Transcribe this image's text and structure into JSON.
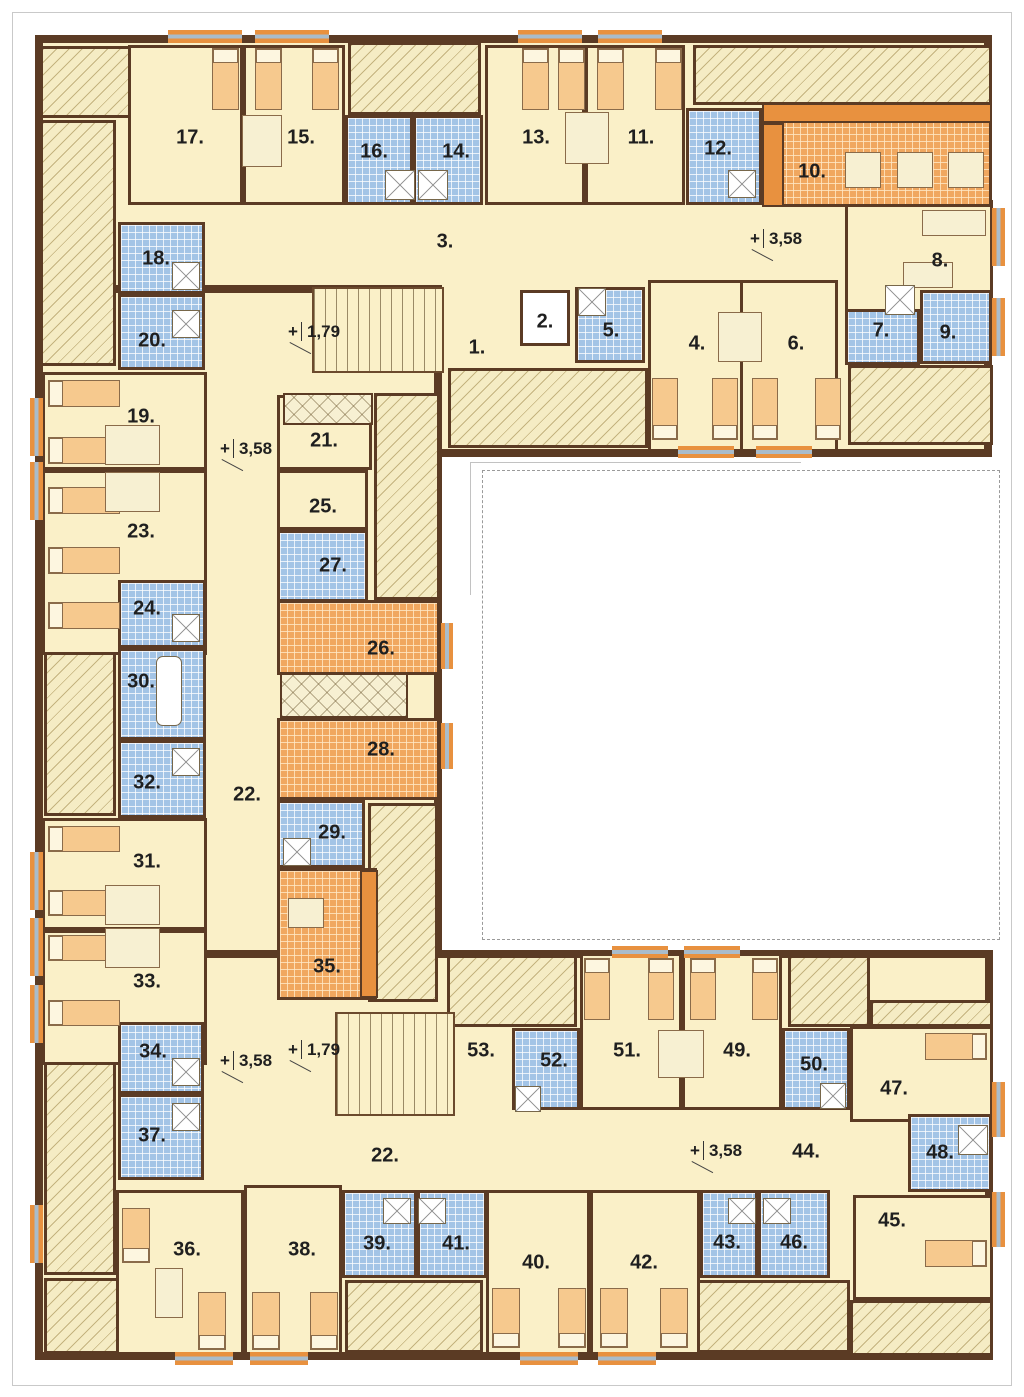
{
  "plan_title": "Floor plan – level +3,58 / +1,79",
  "colors": {
    "wall": "#5b3b24",
    "floor_cream": "#faf0c8",
    "tile_blue": "#a3c4e6",
    "tile_orange": "#f0a75f",
    "accent_orange": "#e8913f",
    "hatch_bg": "#f5ecc4",
    "window_glass": "#a9bccb",
    "bed_orange": "#f6c98e"
  },
  "wings": [
    {
      "name": "wing-top",
      "rect": [
        35,
        35,
        957,
        422
      ]
    },
    {
      "name": "wing-left",
      "rect": [
        35,
        285,
        407,
        912
      ]
    },
    {
      "name": "wing-bottom",
      "rect": [
        35,
        950,
        958,
        410
      ]
    }
  ],
  "hatches": [
    [
      40,
      46,
      93,
      72
    ],
    [
      40,
      120,
      76,
      246
    ],
    [
      348,
      42,
      133,
      73
    ],
    [
      693,
      45,
      299,
      60
    ],
    [
      448,
      368,
      200,
      80
    ],
    [
      848,
      365,
      145,
      80
    ],
    [
      374,
      393,
      66,
      207
    ],
    [
      44,
      580,
      72,
      236
    ],
    [
      368,
      803,
      70,
      199
    ],
    [
      44,
      1022,
      72,
      253
    ],
    [
      44,
      1278,
      93,
      76
    ],
    [
      345,
      1280,
      138,
      73
    ],
    [
      695,
      1280,
      155,
      73
    ],
    [
      447,
      955,
      130,
      72
    ],
    [
      788,
      955,
      82,
      72
    ],
    [
      870,
      1000,
      123,
      27
    ],
    [
      850,
      1300,
      143,
      56
    ]
  ],
  "rooms": [
    {
      "label": "1.",
      "type": "corridor",
      "rect": [
        277,
        285,
        243,
        110
      ],
      "label_pos": [
        477,
        348
      ]
    },
    {
      "label": "2.",
      "type": "elevator",
      "rect": [
        520,
        290,
        50,
        56
      ],
      "label_pos": [
        545,
        322
      ]
    },
    {
      "label": "3.",
      "type": "corridor",
      "rect": [
        205,
        205,
        640,
        80
      ],
      "label_pos": [
        445,
        242
      ]
    },
    {
      "label": "4.",
      "type": "cream",
      "rect": [
        648,
        280,
        95,
        172
      ],
      "label_pos": [
        697,
        344
      ]
    },
    {
      "label": "5.",
      "type": "blue",
      "rect": [
        575,
        287,
        70,
        76
      ],
      "label_pos": [
        611,
        331
      ]
    },
    {
      "label": "6.",
      "type": "cream",
      "rect": [
        740,
        280,
        98,
        172
      ],
      "label_pos": [
        796,
        344
      ]
    },
    {
      "label": "7.",
      "type": "blue",
      "rect": [
        845,
        280,
        75,
        85
      ],
      "label_pos": [
        881,
        331
      ]
    },
    {
      "label": "8.",
      "type": "cream",
      "rect": [
        845,
        200,
        148,
        112
      ],
      "label_pos": [
        940,
        261
      ]
    },
    {
      "label": "9.",
      "type": "blue",
      "rect": [
        920,
        290,
        72,
        74
      ],
      "label_pos": [
        948,
        333
      ]
    },
    {
      "label": "10.",
      "type": "orangetile",
      "rect": [
        762,
        103,
        230,
        104
      ],
      "label_pos": [
        812,
        172
      ]
    },
    {
      "label": "11.",
      "type": "cream",
      "rect": [
        585,
        45,
        100,
        160
      ],
      "label_pos": [
        641,
        138
      ]
    },
    {
      "label": "12.",
      "type": "blue",
      "rect": [
        686,
        108,
        76,
        97
      ],
      "label_pos": [
        718,
        149
      ]
    },
    {
      "label": "13.",
      "type": "cream",
      "rect": [
        485,
        45,
        100,
        160
      ],
      "label_pos": [
        536,
        138
      ]
    },
    {
      "label": "14.",
      "type": "blue",
      "rect": [
        413,
        115,
        70,
        90
      ],
      "label_pos": [
        456,
        152
      ]
    },
    {
      "label": "15.",
      "type": "cream",
      "rect": [
        243,
        45,
        102,
        160
      ],
      "label_pos": [
        301,
        138
      ]
    },
    {
      "label": "16.",
      "type": "blue",
      "rect": [
        345,
        115,
        68,
        90
      ],
      "label_pos": [
        374,
        152
      ]
    },
    {
      "label": "17.",
      "type": "cream",
      "rect": [
        128,
        45,
        115,
        160
      ],
      "label_pos": [
        190,
        138
      ]
    },
    {
      "label": "18.",
      "type": "blue",
      "rect": [
        118,
        222,
        87,
        72
      ],
      "label_pos": [
        156,
        259
      ]
    },
    {
      "label": "19.",
      "type": "cream",
      "rect": [
        42,
        372,
        165,
        98
      ],
      "label_pos": [
        141,
        417
      ]
    },
    {
      "label": "20.",
      "type": "blue",
      "rect": [
        118,
        294,
        87,
        76
      ],
      "label_pos": [
        152,
        341
      ]
    },
    {
      "label": "21.",
      "type": "cream",
      "rect": [
        277,
        395,
        95,
        75
      ],
      "label_pos": [
        324,
        441
      ]
    },
    {
      "label": "22.",
      "type": "corridor",
      "rect": [
        205,
        285,
        72,
        905
      ],
      "label_pos": [
        247,
        795
      ]
    },
    {
      "label": "22.",
      "type": "corridor",
      "rect": [
        277,
        1125,
        490,
        70
      ],
      "label_pos": [
        385,
        1156
      ]
    },
    {
      "label": "23.",
      "type": "cream",
      "rect": [
        42,
        470,
        165,
        185
      ],
      "label_pos": [
        141,
        532
      ]
    },
    {
      "label": "24.",
      "type": "blue",
      "rect": [
        118,
        580,
        88,
        68
      ],
      "label_pos": [
        147,
        609
      ]
    },
    {
      "label": "25.",
      "type": "cream",
      "rect": [
        277,
        470,
        91,
        60
      ],
      "label_pos": [
        323,
        507
      ]
    },
    {
      "label": "26.",
      "type": "orangetile",
      "rect": [
        277,
        600,
        163,
        75
      ],
      "label_pos": [
        381,
        649
      ]
    },
    {
      "label": "27.",
      "type": "blue",
      "rect": [
        277,
        530,
        91,
        72
      ],
      "label_pos": [
        333,
        566
      ]
    },
    {
      "label": "28.",
      "type": "orangetile",
      "rect": [
        277,
        718,
        163,
        82
      ],
      "label_pos": [
        381,
        750
      ]
    },
    {
      "label": "29.",
      "type": "blue",
      "rect": [
        277,
        800,
        88,
        68
      ],
      "label_pos": [
        332,
        833
      ]
    },
    {
      "label": "30.",
      "type": "blue",
      "rect": [
        118,
        648,
        88,
        92
      ],
      "label_pos": [
        141,
        682
      ]
    },
    {
      "label": "31.",
      "type": "cream",
      "rect": [
        42,
        818,
        165,
        112
      ],
      "label_pos": [
        147,
        862
      ]
    },
    {
      "label": "32.",
      "type": "blue",
      "rect": [
        118,
        740,
        88,
        78
      ],
      "label_pos": [
        147,
        783
      ]
    },
    {
      "label": "33.",
      "type": "cream",
      "rect": [
        42,
        930,
        165,
        135
      ],
      "label_pos": [
        147,
        982
      ]
    },
    {
      "label": "34.",
      "type": "blue",
      "rect": [
        118,
        1022,
        86,
        72
      ],
      "label_pos": [
        153,
        1052
      ]
    },
    {
      "label": "35.",
      "type": "orangetile",
      "rect": [
        277,
        868,
        100,
        132
      ],
      "label_pos": [
        327,
        967
      ]
    },
    {
      "label": "36.",
      "type": "cream",
      "rect": [
        116,
        1190,
        128,
        165
      ],
      "label_pos": [
        187,
        1250
      ]
    },
    {
      "label": "37.",
      "type": "blue",
      "rect": [
        118,
        1094,
        86,
        86
      ],
      "label_pos": [
        152,
        1136
      ]
    },
    {
      "label": "38.",
      "type": "cream",
      "rect": [
        244,
        1185,
        98,
        170
      ],
      "label_pos": [
        302,
        1250
      ]
    },
    {
      "label": "39.",
      "type": "blue",
      "rect": [
        342,
        1190,
        75,
        88
      ],
      "label_pos": [
        377,
        1244
      ]
    },
    {
      "label": "40.",
      "type": "cream",
      "rect": [
        486,
        1190,
        104,
        165
      ],
      "label_pos": [
        536,
        1263
      ]
    },
    {
      "label": "41.",
      "type": "blue",
      "rect": [
        417,
        1190,
        70,
        88
      ],
      "label_pos": [
        456,
        1244
      ]
    },
    {
      "label": "42.",
      "type": "cream",
      "rect": [
        590,
        1190,
        110,
        165
      ],
      "label_pos": [
        644,
        1263
      ]
    },
    {
      "label": "43.",
      "type": "blue",
      "rect": [
        700,
        1190,
        58,
        88
      ],
      "label_pos": [
        727,
        1243
      ]
    },
    {
      "label": "44.",
      "type": "corridor",
      "rect": [
        760,
        1120,
        95,
        75
      ],
      "label_pos": [
        806,
        1152
      ]
    },
    {
      "label": "45.",
      "type": "cream",
      "rect": [
        853,
        1195,
        140,
        105
      ],
      "label_pos": [
        892,
        1221
      ]
    },
    {
      "label": "46.",
      "type": "blue",
      "rect": [
        758,
        1190,
        72,
        88
      ],
      "label_pos": [
        794,
        1243
      ]
    },
    {
      "label": "47.",
      "type": "cream",
      "rect": [
        850,
        1026,
        143,
        96
      ],
      "label_pos": [
        894,
        1089
      ]
    },
    {
      "label": "48.",
      "type": "blue",
      "rect": [
        908,
        1114,
        84,
        78
      ],
      "label_pos": [
        940,
        1153
      ]
    },
    {
      "label": "49.",
      "type": "cream",
      "rect": [
        682,
        953,
        100,
        157
      ],
      "label_pos": [
        737,
        1051
      ]
    },
    {
      "label": "50.",
      "type": "blue",
      "rect": [
        782,
        1028,
        68,
        82
      ],
      "label_pos": [
        814,
        1065
      ]
    },
    {
      "label": "51.",
      "type": "cream",
      "rect": [
        580,
        953,
        102,
        157
      ],
      "label_pos": [
        627,
        1051
      ]
    },
    {
      "label": "52.",
      "type": "blue",
      "rect": [
        512,
        1028,
        68,
        82
      ],
      "label_pos": [
        554,
        1061
      ]
    },
    {
      "label": "53.",
      "type": "corridor",
      "rect": [
        447,
        1026,
        65,
        84
      ],
      "label_pos": [
        481,
        1051
      ]
    }
  ],
  "stairs": [
    {
      "rect": [
        312,
        287,
        132,
        86
      ]
    },
    {
      "rect": [
        335,
        1012,
        120,
        104
      ]
    }
  ],
  "wardrobes": [
    [
      280,
      673,
      128,
      45
    ],
    [
      283,
      393,
      90,
      32
    ]
  ],
  "counters": [
    [
      762,
      103,
      230,
      20
    ],
    [
      762,
      123,
      22,
      84
    ],
    [
      360,
      870,
      18,
      128
    ]
  ],
  "beds": [
    {
      "r": [
        212,
        48,
        27,
        62
      ],
      "dir": "up"
    },
    {
      "r": [
        255,
        48,
        27,
        62
      ],
      "dir": "up"
    },
    {
      "r": [
        312,
        48,
        27,
        62
      ],
      "dir": "up"
    },
    {
      "r": [
        522,
        48,
        27,
        62
      ],
      "dir": "up"
    },
    {
      "r": [
        558,
        48,
        27,
        62
      ],
      "dir": "up"
    },
    {
      "r": [
        597,
        48,
        27,
        62
      ],
      "dir": "up"
    },
    {
      "r": [
        655,
        48,
        27,
        62
      ],
      "dir": "up"
    },
    {
      "r": [
        652,
        378,
        26,
        62
      ],
      "dir": "down"
    },
    {
      "r": [
        712,
        378,
        26,
        62
      ],
      "dir": "down"
    },
    {
      "r": [
        752,
        378,
        26,
        62
      ],
      "dir": "down"
    },
    {
      "r": [
        815,
        378,
        26,
        62
      ],
      "dir": "down"
    },
    {
      "r": [
        48,
        380,
        72,
        27
      ],
      "dir": "left"
    },
    {
      "r": [
        48,
        437,
        72,
        27
      ],
      "dir": "left"
    },
    {
      "r": [
        48,
        487,
        72,
        27
      ],
      "dir": "left"
    },
    {
      "r": [
        48,
        547,
        72,
        27
      ],
      "dir": "left"
    },
    {
      "r": [
        48,
        602,
        72,
        27
      ],
      "dir": "left"
    },
    {
      "r": [
        48,
        826,
        72,
        26
      ],
      "dir": "left"
    },
    {
      "r": [
        48,
        890,
        72,
        26
      ],
      "dir": "left"
    },
    {
      "r": [
        48,
        935,
        72,
        26
      ],
      "dir": "left"
    },
    {
      "r": [
        48,
        1000,
        72,
        26
      ],
      "dir": "left"
    },
    {
      "r": [
        122,
        1208,
        28,
        55
      ],
      "dir": "down"
    },
    {
      "r": [
        198,
        1292,
        28,
        58
      ],
      "dir": "down"
    },
    {
      "r": [
        252,
        1292,
        28,
        58
      ],
      "dir": "down"
    },
    {
      "r": [
        310,
        1292,
        28,
        58
      ],
      "dir": "down"
    },
    {
      "r": [
        492,
        1288,
        28,
        60
      ],
      "dir": "down"
    },
    {
      "r": [
        558,
        1288,
        28,
        60
      ],
      "dir": "down"
    },
    {
      "r": [
        600,
        1288,
        28,
        60
      ],
      "dir": "down"
    },
    {
      "r": [
        660,
        1288,
        28,
        60
      ],
      "dir": "down"
    },
    {
      "r": [
        584,
        958,
        26,
        62
      ],
      "dir": "up"
    },
    {
      "r": [
        648,
        958,
        26,
        62
      ],
      "dir": "up"
    },
    {
      "r": [
        690,
        958,
        26,
        62
      ],
      "dir": "up"
    },
    {
      "r": [
        752,
        958,
        26,
        62
      ],
      "dir": "up"
    },
    {
      "r": [
        925,
        1033,
        62,
        27
      ],
      "dir": "right"
    },
    {
      "r": [
        925,
        1240,
        62,
        27
      ],
      "dir": "right"
    }
  ],
  "tables": [
    [
      242,
      115,
      40,
      52
    ],
    [
      565,
      112,
      44,
      52
    ],
    [
      718,
      312,
      44,
      50
    ],
    [
      105,
      425,
      55,
      40
    ],
    [
      105,
      472,
      55,
      40
    ],
    [
      105,
      885,
      55,
      40
    ],
    [
      105,
      928,
      55,
      40
    ],
    [
      658,
      1030,
      46,
      48
    ],
    [
      845,
      152,
      36,
      36
    ],
    [
      897,
      152,
      36,
      36
    ],
    [
      948,
      152,
      36,
      36
    ],
    [
      288,
      898,
      36,
      30
    ],
    [
      155,
      1268,
      28,
      50
    ],
    [
      922,
      210,
      64,
      26
    ],
    [
      903,
      262,
      50,
      26
    ]
  ],
  "showers": [
    [
      385,
      170,
      30,
      30
    ],
    [
      418,
      170,
      30,
      30
    ],
    [
      578,
      288,
      28,
      28
    ],
    [
      885,
      285,
      30,
      30
    ],
    [
      728,
      170,
      28,
      28
    ],
    [
      172,
      262,
      28,
      28
    ],
    [
      172,
      310,
      28,
      28
    ],
    [
      172,
      614,
      28,
      28
    ],
    [
      172,
      748,
      28,
      28
    ],
    [
      172,
      1058,
      28,
      28
    ],
    [
      172,
      1103,
      28,
      28
    ],
    [
      283,
      838,
      28,
      28
    ],
    [
      515,
      1086,
      26,
      26
    ],
    [
      820,
      1083,
      26,
      26
    ],
    [
      958,
      1125,
      30,
      30
    ],
    [
      383,
      1198,
      28,
      26
    ],
    [
      418,
      1198,
      28,
      26
    ],
    [
      728,
      1198,
      28,
      26
    ],
    [
      763,
      1198,
      28,
      26
    ]
  ],
  "tubs": [
    [
      156,
      656,
      26,
      70
    ]
  ],
  "windows": [
    [
      168,
      30,
      74,
      13
    ],
    [
      255,
      30,
      74,
      13
    ],
    [
      518,
      30,
      64,
      13
    ],
    [
      598,
      30,
      64,
      13
    ],
    [
      175,
      1352,
      58,
      13
    ],
    [
      250,
      1352,
      58,
      13
    ],
    [
      520,
      1352,
      58,
      13
    ],
    [
      598,
      1352,
      58,
      13
    ],
    [
      30,
      398,
      13,
      58
    ],
    [
      30,
      462,
      13,
      58
    ],
    [
      30,
      852,
      13,
      58
    ],
    [
      30,
      918,
      13,
      58
    ],
    [
      30,
      985,
      13,
      58
    ],
    [
      30,
      1205,
      13,
      58
    ],
    [
      992,
      208,
      13,
      58
    ],
    [
      992,
      298,
      13,
      58
    ],
    [
      992,
      1082,
      13,
      55
    ],
    [
      992,
      1192,
      13,
      55
    ],
    [
      678,
      446,
      56,
      12
    ],
    [
      756,
      446,
      56,
      12
    ],
    [
      612,
      946,
      56,
      12
    ],
    [
      684,
      946,
      56,
      12
    ],
    [
      441,
      623,
      12,
      46
    ],
    [
      441,
      723,
      12,
      46
    ]
  ],
  "annotations": [
    {
      "text_plus": "+",
      "value": "3,58",
      "x": 750,
      "y": 229
    },
    {
      "text_plus": "+",
      "value": "1,79",
      "x": 288,
      "y": 322
    },
    {
      "text_plus": "+",
      "value": "3,58",
      "x": 220,
      "y": 439
    },
    {
      "text_plus": "+",
      "value": "3,58",
      "x": 220,
      "y": 1051
    },
    {
      "text_plus": "+",
      "value": "1,79",
      "x": 288,
      "y": 1040
    },
    {
      "text_plus": "+",
      "value": "3,58",
      "x": 690,
      "y": 1141
    }
  ]
}
